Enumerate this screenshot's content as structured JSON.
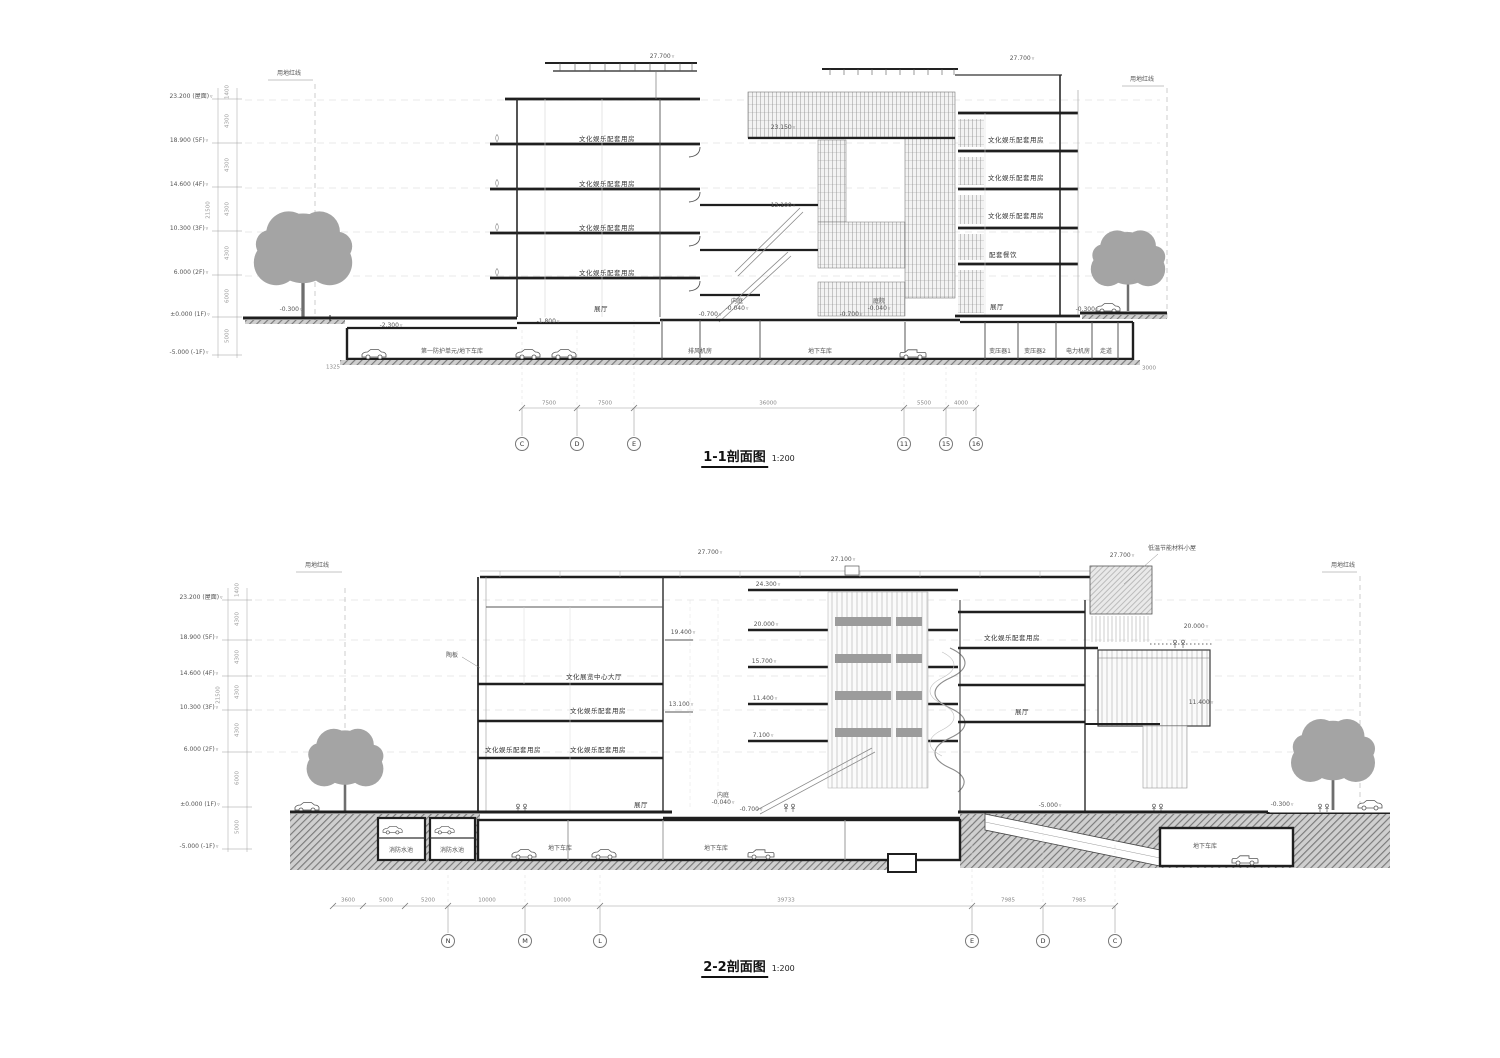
{
  "drawing_colors": {
    "line": "#1f1f1f",
    "light_line": "#999999",
    "tree": "#a4a4a4",
    "earth_bg": "#cfcfcf"
  },
  "sections": [
    {
      "title": "1-1剖面图",
      "scale": "1:200",
      "labels": [
        {
          "t": "用地红线",
          "x": 289,
          "y": 74,
          "c": "sm"
        },
        {
          "t": "用地红线",
          "x": 1142,
          "y": 80,
          "c": "sm"
        },
        {
          "t": "23.200 (屋面)",
          "x": 191,
          "y": 97,
          "c": "elv"
        },
        {
          "t": "18.900 (5F)",
          "x": 189,
          "y": 141,
          "c": "elv"
        },
        {
          "t": "14.600 (4F)",
          "x": 189,
          "y": 185,
          "c": "elv"
        },
        {
          "t": "10.300 (3F)",
          "x": 189,
          "y": 229,
          "c": "elv"
        },
        {
          "t": "6.000 (2F)",
          "x": 191,
          "y": 273,
          "c": "elv"
        },
        {
          "t": "±0.000 (1F)",
          "x": 190,
          "y": 315,
          "c": "elv"
        },
        {
          "t": "-5.000 (-1F)",
          "x": 189,
          "y": 353,
          "c": "elv"
        },
        {
          "t": "1400",
          "x": 228,
          "y": 92,
          "c": "rot"
        },
        {
          "t": "4300",
          "x": 228,
          "y": 121,
          "c": "rot"
        },
        {
          "t": "4300",
          "x": 228,
          "y": 165,
          "c": "rot"
        },
        {
          "t": "4300",
          "x": 228,
          "y": 209,
          "c": "rot"
        },
        {
          "t": "4300",
          "x": 228,
          "y": 253,
          "c": "rot"
        },
        {
          "t": "6000",
          "x": 228,
          "y": 296,
          "c": "rot"
        },
        {
          "t": "5000",
          "x": 228,
          "y": 336,
          "c": "rot"
        },
        {
          "t": "21500",
          "x": 209,
          "y": 210,
          "c": "rot"
        },
        {
          "t": "27.700",
          "x": 662,
          "y": 57,
          "c": "elv"
        },
        {
          "t": "27.700",
          "x": 1022,
          "y": 59,
          "c": "elv"
        },
        {
          "t": "23.150",
          "x": 783,
          "y": 128,
          "c": "elv"
        },
        {
          "t": "13.100",
          "x": 783,
          "y": 206,
          "c": "elv"
        },
        {
          "t": "文化娱乐配套用房",
          "x": 607,
          "y": 139,
          "c": "room"
        },
        {
          "t": "文化娱乐配套用房",
          "x": 607,
          "y": 184,
          "c": "room"
        },
        {
          "t": "文化娱乐配套用房",
          "x": 607,
          "y": 228,
          "c": "room"
        },
        {
          "t": "文化娱乐配套用房",
          "x": 607,
          "y": 273,
          "c": "room"
        },
        {
          "t": "展厅",
          "x": 601,
          "y": 309,
          "c": "room"
        },
        {
          "t": "文化娱乐配套用房",
          "x": 1016,
          "y": 140,
          "c": "room"
        },
        {
          "t": "文化娱乐配套用房",
          "x": 1016,
          "y": 178,
          "c": "room"
        },
        {
          "t": "文化娱乐配套用房",
          "x": 1016,
          "y": 216,
          "c": "room"
        },
        {
          "t": "配套餐饮",
          "x": 1003,
          "y": 255,
          "c": "room"
        },
        {
          "t": "展厅",
          "x": 997,
          "y": 307,
          "c": "room"
        },
        {
          "t": "-0.300",
          "x": 291,
          "y": 310,
          "c": "elv"
        },
        {
          "t": "-2.300",
          "x": 391,
          "y": 326,
          "c": "elv"
        },
        {
          "t": "-1.800",
          "x": 548,
          "y": 322,
          "c": "elv"
        },
        {
          "t": "内庭",
          "x": 737,
          "y": 302,
          "c": "sm"
        },
        {
          "t": "-0.040",
          "x": 737,
          "y": 309,
          "c": "elv"
        },
        {
          "t": "-0.700",
          "x": 710,
          "y": 315,
          "c": "elv"
        },
        {
          "t": "庭院",
          "x": 879,
          "y": 302,
          "c": "sm"
        },
        {
          "t": "-0.040",
          "x": 879,
          "y": 309,
          "c": "elv"
        },
        {
          "t": "-0.700",
          "x": 851,
          "y": 315,
          "c": "elv"
        },
        {
          "t": "-0.300",
          "x": 1087,
          "y": 310,
          "c": "elv"
        },
        {
          "t": "第一防护单元/地下车库",
          "x": 452,
          "y": 352,
          "c": "sm"
        },
        {
          "t": "排风机房",
          "x": 700,
          "y": 352,
          "c": "sm"
        },
        {
          "t": "地下车库",
          "x": 820,
          "y": 352,
          "c": "sm"
        },
        {
          "t": "变压器1",
          "x": 1000,
          "y": 352,
          "c": "sm"
        },
        {
          "t": "变压器2",
          "x": 1035,
          "y": 352,
          "c": "sm"
        },
        {
          "t": "电力机房",
          "x": 1078,
          "y": 352,
          "c": "sm"
        },
        {
          "t": "走道",
          "x": 1106,
          "y": 352,
          "c": "sm"
        },
        {
          "t": "1325",
          "x": 333,
          "y": 368,
          "c": "dim"
        },
        {
          "t": "3000",
          "x": 1149,
          "y": 369,
          "c": "dim"
        },
        {
          "t": "7500",
          "x": 549,
          "y": 404,
          "c": "dim"
        },
        {
          "t": "7500",
          "x": 605,
          "y": 404,
          "c": "dim"
        },
        {
          "t": "36000",
          "x": 768,
          "y": 404,
          "c": "dim"
        },
        {
          "t": "5500",
          "x": 924,
          "y": 404,
          "c": "dim"
        },
        {
          "t": "4000",
          "x": 961,
          "y": 404,
          "c": "dim"
        },
        {
          "t": "C",
          "x": 522,
          "y": 444,
          "c": "bub"
        },
        {
          "t": "D",
          "x": 577,
          "y": 444,
          "c": "bub"
        },
        {
          "t": "E",
          "x": 634,
          "y": 444,
          "c": "bub"
        },
        {
          "t": "11",
          "x": 904,
          "y": 444,
          "c": "bub"
        },
        {
          "t": "15",
          "x": 946,
          "y": 444,
          "c": "bub"
        },
        {
          "t": "16",
          "x": 976,
          "y": 444,
          "c": "bub"
        }
      ]
    },
    {
      "title": "2-2剖面图",
      "scale": "1:200",
      "labels": [
        {
          "t": "用地红线",
          "x": 317,
          "y": 566,
          "c": "sm"
        },
        {
          "t": "用地红线",
          "x": 1343,
          "y": 566,
          "c": "sm"
        },
        {
          "t": "低温节能材料小屋",
          "x": 1172,
          "y": 549,
          "c": "sm"
        },
        {
          "t": "23.200 (屋面)",
          "x": 201,
          "y": 598,
          "c": "elv"
        },
        {
          "t": "18.900 (5F)",
          "x": 199,
          "y": 638,
          "c": "elv"
        },
        {
          "t": "14.600 (4F)",
          "x": 199,
          "y": 674,
          "c": "elv"
        },
        {
          "t": "10.300 (3F)",
          "x": 199,
          "y": 708,
          "c": "elv"
        },
        {
          "t": "6.000 (2F)",
          "x": 201,
          "y": 750,
          "c": "elv"
        },
        {
          "t": "±0.000 (1F)",
          "x": 200,
          "y": 805,
          "c": "elv"
        },
        {
          "t": "-5.000 (-1F)",
          "x": 199,
          "y": 847,
          "c": "elv"
        },
        {
          "t": "1400",
          "x": 238,
          "y": 590,
          "c": "rot"
        },
        {
          "t": "4300",
          "x": 238,
          "y": 619,
          "c": "rot"
        },
        {
          "t": "4300",
          "x": 238,
          "y": 657,
          "c": "rot"
        },
        {
          "t": "4300",
          "x": 238,
          "y": 692,
          "c": "rot"
        },
        {
          "t": "4300",
          "x": 238,
          "y": 730,
          "c": "rot"
        },
        {
          "t": "6000",
          "x": 238,
          "y": 778,
          "c": "rot"
        },
        {
          "t": "5000",
          "x": 238,
          "y": 827,
          "c": "rot"
        },
        {
          "t": "21500",
          "x": 219,
          "y": 695,
          "c": "rot"
        },
        {
          "t": "27.700",
          "x": 710,
          "y": 553,
          "c": "elv"
        },
        {
          "t": "27.100",
          "x": 843,
          "y": 560,
          "c": "elv"
        },
        {
          "t": "24.300",
          "x": 768,
          "y": 585,
          "c": "elv"
        },
        {
          "t": "27.700",
          "x": 1122,
          "y": 556,
          "c": "elv"
        },
        {
          "t": "陶板",
          "x": 452,
          "y": 656,
          "c": "sm"
        },
        {
          "t": "文化展览中心大厅",
          "x": 594,
          "y": 677,
          "c": "room"
        },
        {
          "t": "文化娱乐配套用房",
          "x": 598,
          "y": 711,
          "c": "room"
        },
        {
          "t": "文化娱乐配套用房",
          "x": 513,
          "y": 750,
          "c": "room"
        },
        {
          "t": "文化娱乐配套用房",
          "x": 598,
          "y": 750,
          "c": "room"
        },
        {
          "t": "展厅",
          "x": 641,
          "y": 805,
          "c": "room"
        },
        {
          "t": "19.400",
          "x": 683,
          "y": 633,
          "c": "elv"
        },
        {
          "t": "13.100",
          "x": 681,
          "y": 705,
          "c": "elv"
        },
        {
          "t": "20.000",
          "x": 766,
          "y": 625,
          "c": "elv"
        },
        {
          "t": "15.700",
          "x": 764,
          "y": 662,
          "c": "elv"
        },
        {
          "t": "11.400",
          "x": 765,
          "y": 699,
          "c": "elv"
        },
        {
          "t": "7.100",
          "x": 763,
          "y": 736,
          "c": "elv"
        },
        {
          "t": "文化娱乐配套用房",
          "x": 1012,
          "y": 638,
          "c": "room"
        },
        {
          "t": "展厅",
          "x": 1022,
          "y": 712,
          "c": "room"
        },
        {
          "t": "20.000",
          "x": 1196,
          "y": 627,
          "c": "elv"
        },
        {
          "t": "11.400",
          "x": 1201,
          "y": 703,
          "c": "elv"
        },
        {
          "t": "内庭",
          "x": 723,
          "y": 796,
          "c": "sm"
        },
        {
          "t": "-0.040",
          "x": 723,
          "y": 803,
          "c": "elv"
        },
        {
          "t": "-0.700",
          "x": 751,
          "y": 810,
          "c": "elv"
        },
        {
          "t": "-5.000",
          "x": 1050,
          "y": 806,
          "c": "elv"
        },
        {
          "t": "-0.300",
          "x": 1282,
          "y": 805,
          "c": "elv"
        },
        {
          "t": "消防水池",
          "x": 401,
          "y": 851,
          "c": "sm"
        },
        {
          "t": "消防水池",
          "x": 452,
          "y": 851,
          "c": "sm"
        },
        {
          "t": "地下车库",
          "x": 560,
          "y": 849,
          "c": "sm"
        },
        {
          "t": "地下车库",
          "x": 716,
          "y": 849,
          "c": "sm"
        },
        {
          "t": "地下车库",
          "x": 1205,
          "y": 847,
          "c": "sm"
        },
        {
          "t": "3600",
          "x": 348,
          "y": 901,
          "c": "dim"
        },
        {
          "t": "5000",
          "x": 386,
          "y": 901,
          "c": "dim"
        },
        {
          "t": "5200",
          "x": 428,
          "y": 901,
          "c": "dim"
        },
        {
          "t": "10000",
          "x": 487,
          "y": 901,
          "c": "dim"
        },
        {
          "t": "10000",
          "x": 562,
          "y": 901,
          "c": "dim"
        },
        {
          "t": "39733",
          "x": 786,
          "y": 901,
          "c": "dim"
        },
        {
          "t": "7985",
          "x": 1008,
          "y": 901,
          "c": "dim"
        },
        {
          "t": "7985",
          "x": 1079,
          "y": 901,
          "c": "dim"
        },
        {
          "t": "N",
          "x": 448,
          "y": 941,
          "c": "bub"
        },
        {
          "t": "M",
          "x": 525,
          "y": 941,
          "c": "bub"
        },
        {
          "t": "L",
          "x": 600,
          "y": 941,
          "c": "bub"
        },
        {
          "t": "E",
          "x": 972,
          "y": 941,
          "c": "bub"
        },
        {
          "t": "D",
          "x": 1043,
          "y": 941,
          "c": "bub"
        },
        {
          "t": "C",
          "x": 1115,
          "y": 941,
          "c": "bub"
        }
      ]
    }
  ]
}
